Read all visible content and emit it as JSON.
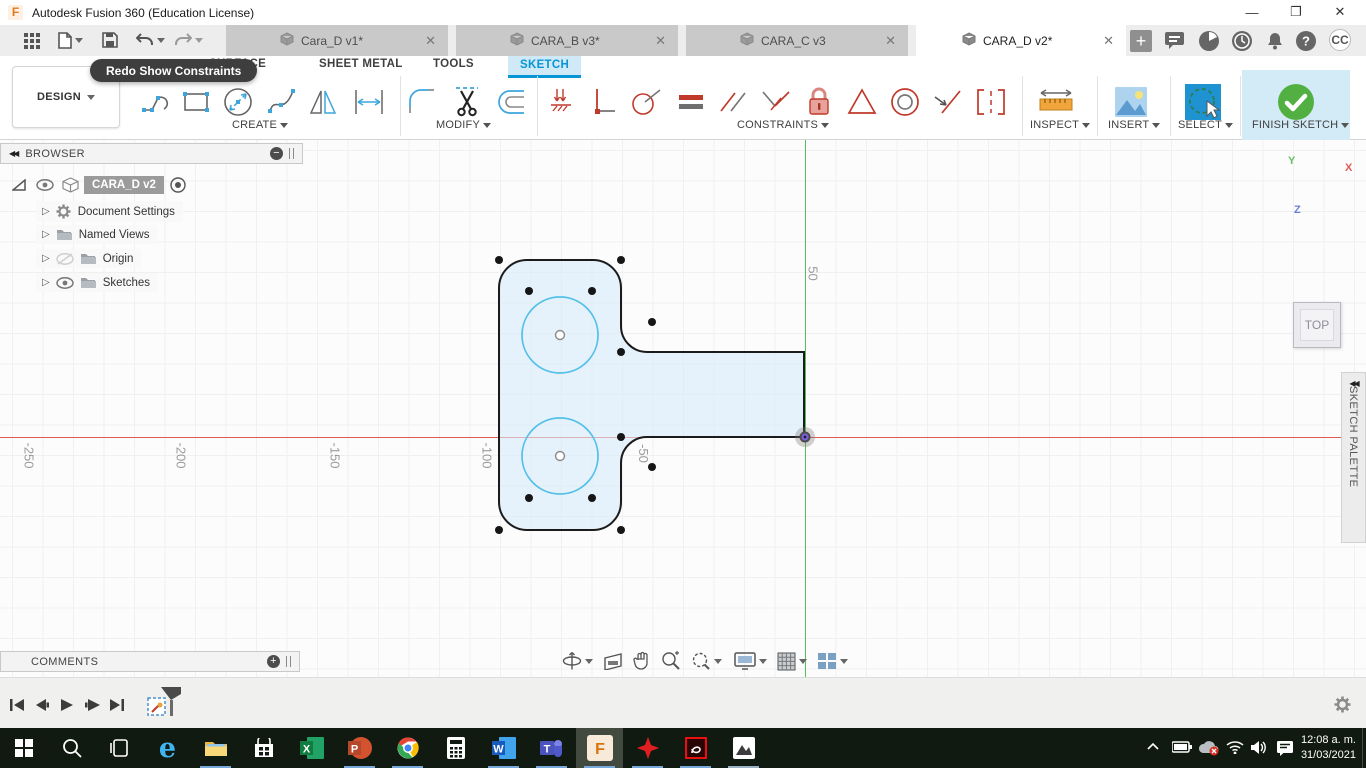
{
  "window": {
    "title": "Autodesk Fusion 360 (Education License)"
  },
  "document_tabs": [
    {
      "label": "Cara_D v1*"
    },
    {
      "label": "CARA_B v3*"
    },
    {
      "label": "CARA_C v3"
    },
    {
      "label": "CARA_D v2*"
    }
  ],
  "avatar": "CC",
  "ribbon": {
    "workspace": "DESIGN",
    "tabs": {
      "surface": "SURFACE",
      "sheet_metal": "SHEET METAL",
      "tools": "TOOLS",
      "sketch": "SKETCH"
    },
    "groups": {
      "create": "CREATE",
      "modify": "MODIFY",
      "constraints": "CONSTRAINTS",
      "inspect": "INSPECT",
      "insert": "INSERT",
      "select": "SELECT",
      "finish": "FINISH SKETCH"
    }
  },
  "tooltip": "Redo Show Constraints",
  "browser": {
    "title": "BROWSER",
    "root": "CARA_D v2",
    "items": [
      {
        "label": "Document Settings"
      },
      {
        "label": "Named Views"
      },
      {
        "label": "Origin"
      },
      {
        "label": "Sketches"
      }
    ]
  },
  "comments": {
    "title": "COMMENTS"
  },
  "viewcube": {
    "face": "TOP",
    "axis_x": "X",
    "axis_y": "Y",
    "axis_z": "Z"
  },
  "sketch_palette": {
    "title": "SKETCH PALETTE"
  },
  "canvas": {
    "x_axis_labels": [
      "-250",
      "-200",
      "-150",
      "-100",
      "-50"
    ],
    "y_axis_labels": [
      "50"
    ],
    "colors": {
      "x_axis": "#e05b55",
      "y_axis": "#57bf57",
      "profile_fill": "#ddeefa",
      "sketch_circle": "#53c0e8"
    }
  },
  "taskbar": {
    "time": "12:08 a. m.",
    "date": "31/03/2021"
  }
}
